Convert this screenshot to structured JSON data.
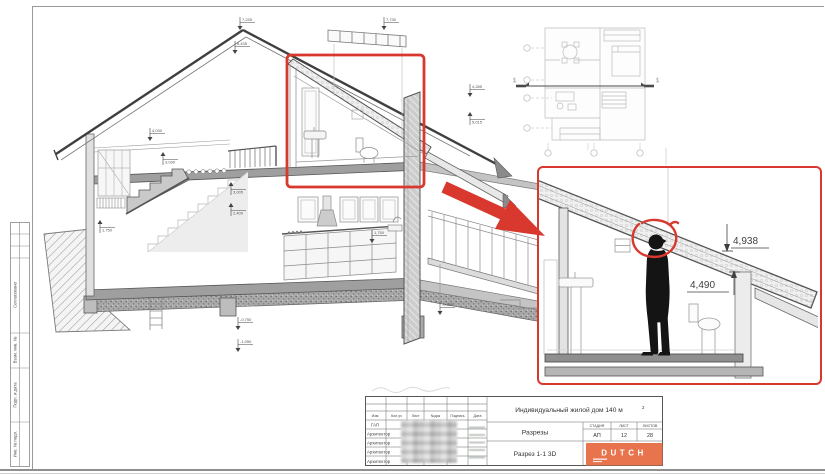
{
  "colors": {
    "accent_red": "#D9382F",
    "logo_orange": "#E8744E"
  },
  "side_stamp": {
    "labels": [
      "Согласовано",
      "Взам. инв. №",
      "Подп. и дата",
      "Инв. № подл."
    ]
  },
  "plan": {
    "section_mark_left": "1",
    "section_mark_right": "1"
  },
  "drawing": {
    "elevations": [
      "7,730",
      "7,245",
      "6,435",
      "4,030",
      "3,030",
      "3,005",
      "2,400",
      "1,750",
      "4,285",
      "5,015",
      "1,750",
      "-0,350",
      "-0,750",
      "-1,050"
    ]
  },
  "detail": {
    "dim_upper": "4,938",
    "dim_lower": "4,490"
  },
  "title_block": {
    "columns": [
      "Изм.",
      "Кол.уч",
      "Лист",
      "№док",
      "Подпись",
      "Дата"
    ],
    "roles": [
      "ГАП",
      "Архитектор",
      "Архитектор",
      "Архитектор",
      "Архитектор"
    ],
    "project": "Индивидуальный жилой дом 140 м",
    "project_sup": "2",
    "doc_title": "Разрезы",
    "view_title": "Разрез 1-1 3D",
    "stage_header": [
      "СТАДИЯ",
      "ЛИСТ",
      "ЛИСТОВ"
    ],
    "stage_values": [
      "АП",
      "12",
      "28"
    ],
    "logo_text": "DUTCH"
  }
}
